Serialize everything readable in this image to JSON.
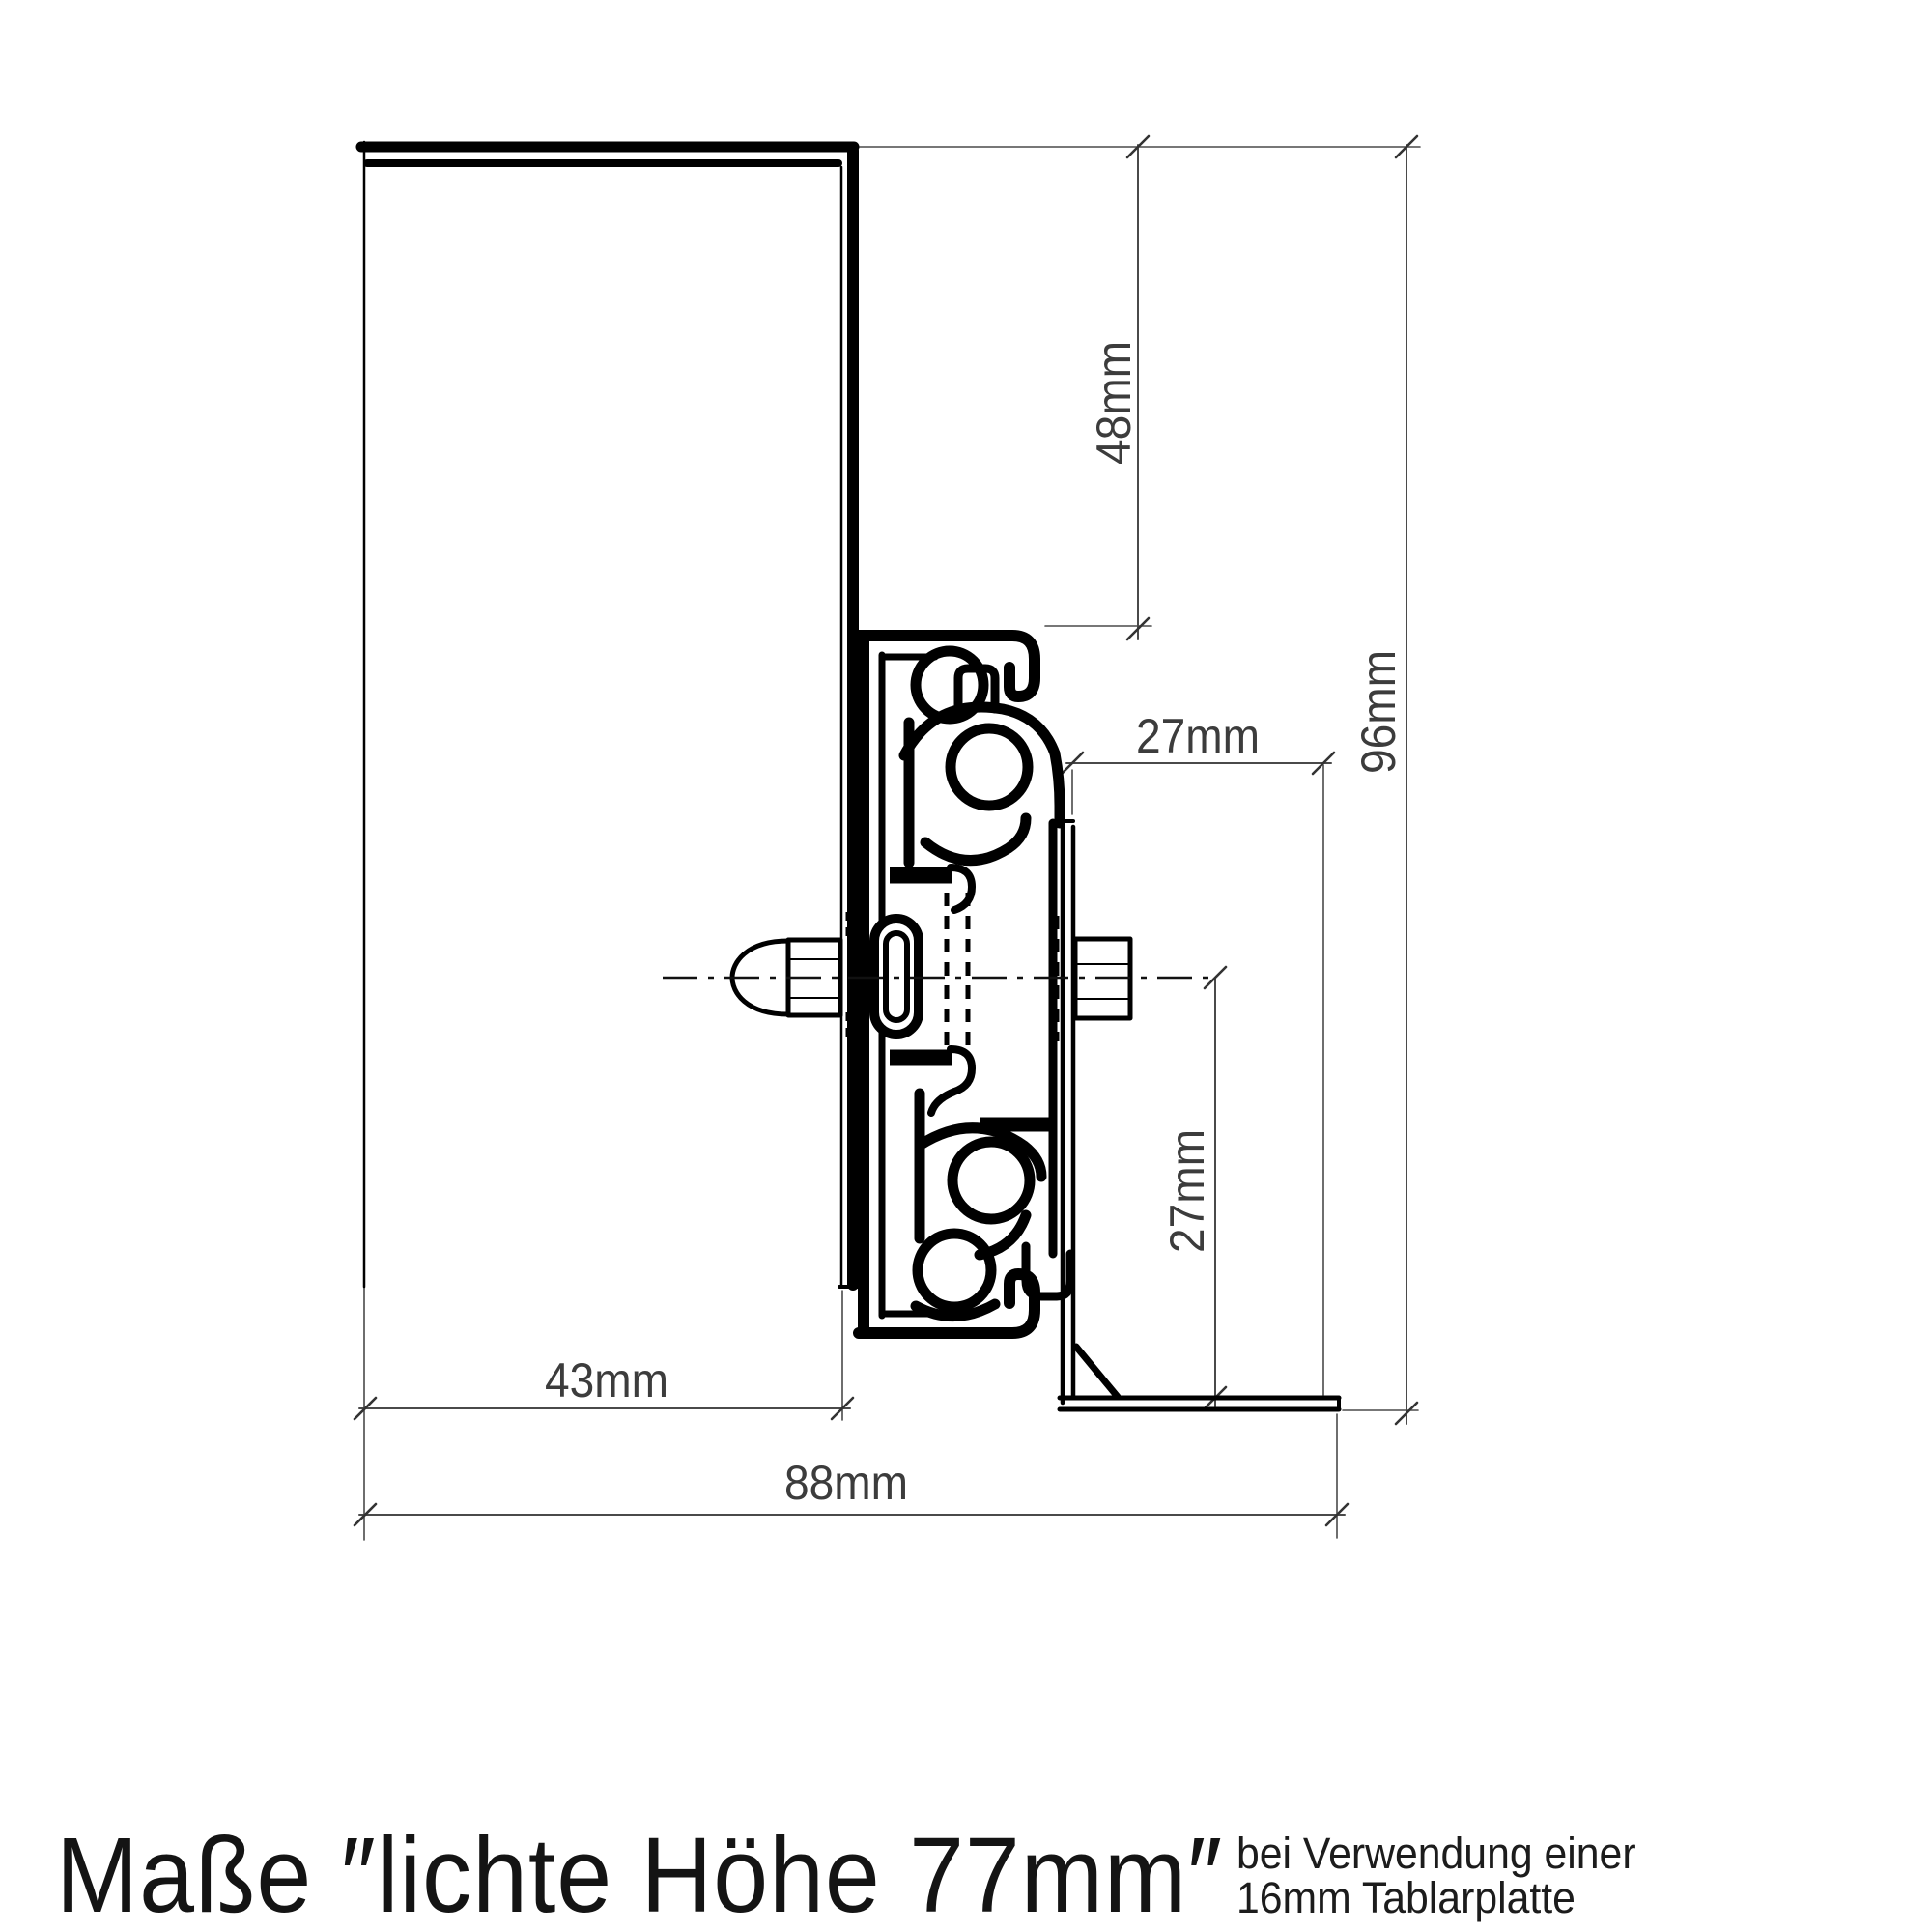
{
  "drawing": {
    "title": "Maße ″lichte Höhe 77mm″",
    "note_line1": "bei Verwendung einer",
    "note_line2": "16mm Tablarplatte",
    "dimensions": {
      "top_offset": "48mm",
      "total_height": "96mm",
      "bracket_depth": "27mm",
      "bracket_height": "27mm",
      "panel_depth": "43mm",
      "total_depth": "88mm"
    },
    "colors": {
      "ink": "#000000",
      "dimension_lines": "#4a4a4a",
      "dimension_text": "#3c3c3c",
      "background": "#ffffff"
    }
  }
}
